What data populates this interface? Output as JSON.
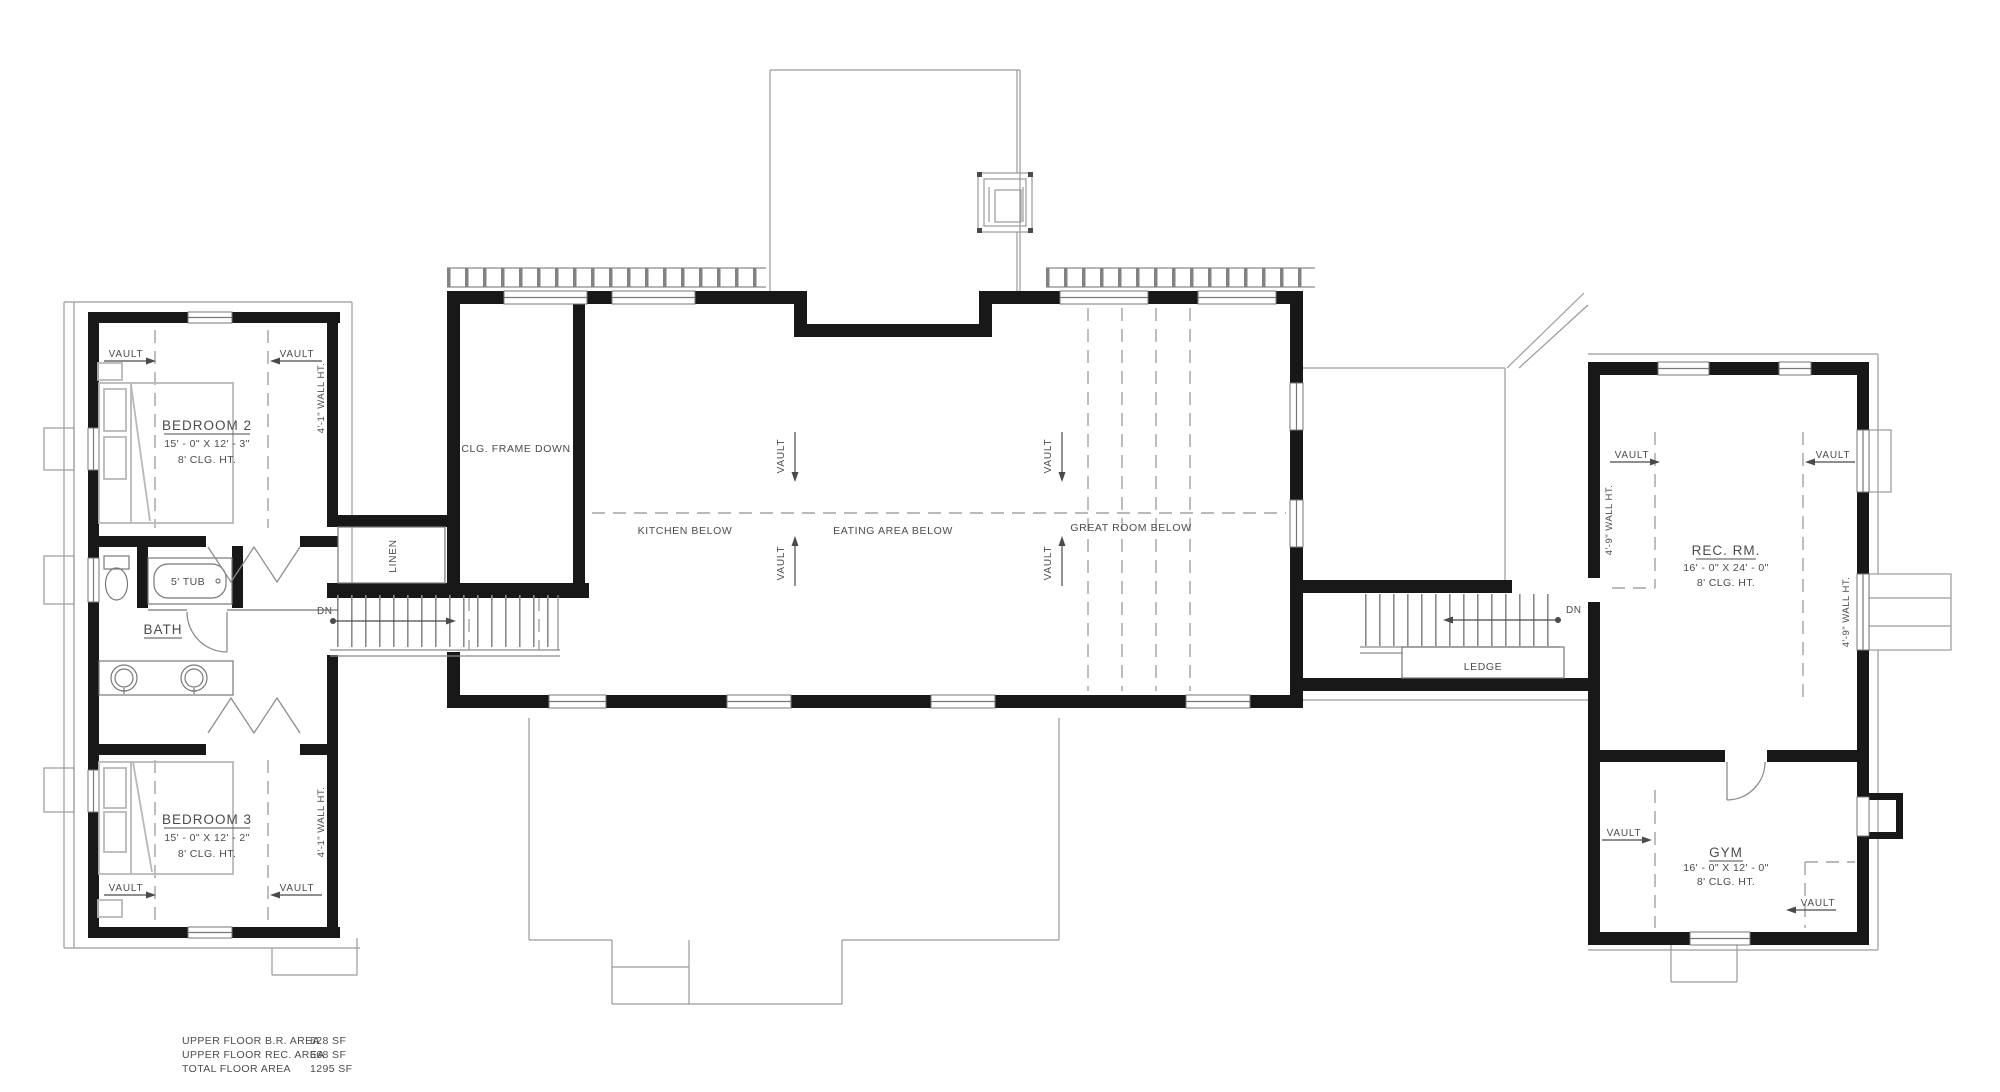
{
  "rooms": {
    "bedroom2": {
      "name": "BEDROOM 2",
      "dims": "15' - 0\" X 12' - 3\"",
      "ceiling": "8' CLG. HT."
    },
    "bedroom3": {
      "name": "BEDROOM 3",
      "dims": "15' - 0\" X 12' - 2\"",
      "ceiling": "8' CLG. HT."
    },
    "bath": {
      "name": "BATH"
    },
    "rec_room": {
      "name": "REC. RM.",
      "dims": "16' - 0\" X 24' - 0\"",
      "ceiling": "8' CLG. HT."
    },
    "gym": {
      "name": "GYM",
      "dims": "16' - 0\" X 12' - 0\"",
      "ceiling": "8' CLG. HT."
    }
  },
  "annotations": {
    "vault": "VAULT",
    "dn": "DN",
    "ledge": "LEDGE",
    "linen": "LINEN",
    "tub": "5' TUB",
    "clg_frame_down": "CLG. FRAME DOWN",
    "kitchen_below": "KITCHEN BELOW",
    "eating_area_below": "EATING AREA BELOW",
    "great_room_below": "GREAT ROOM BELOW",
    "wall_ht_4_1": "4'-1\" WALL HT.",
    "wall_ht_4_9": "4'-9\" WALL HT."
  },
  "area_table": {
    "rows": [
      {
        "label": "UPPER FLOOR B.R. AREA",
        "value": "628 SF"
      },
      {
        "label": "UPPER FLOOR REC. AREA",
        "value": "668 SF"
      },
      {
        "label": "TOTAL FLOOR AREA",
        "value": "1295 SF"
      }
    ]
  },
  "colors": {
    "wall": "#181818",
    "thin_line": "#787878",
    "roof_line": "#9a9a9a",
    "text": "#4c4c4c",
    "background": "#ffffff"
  }
}
